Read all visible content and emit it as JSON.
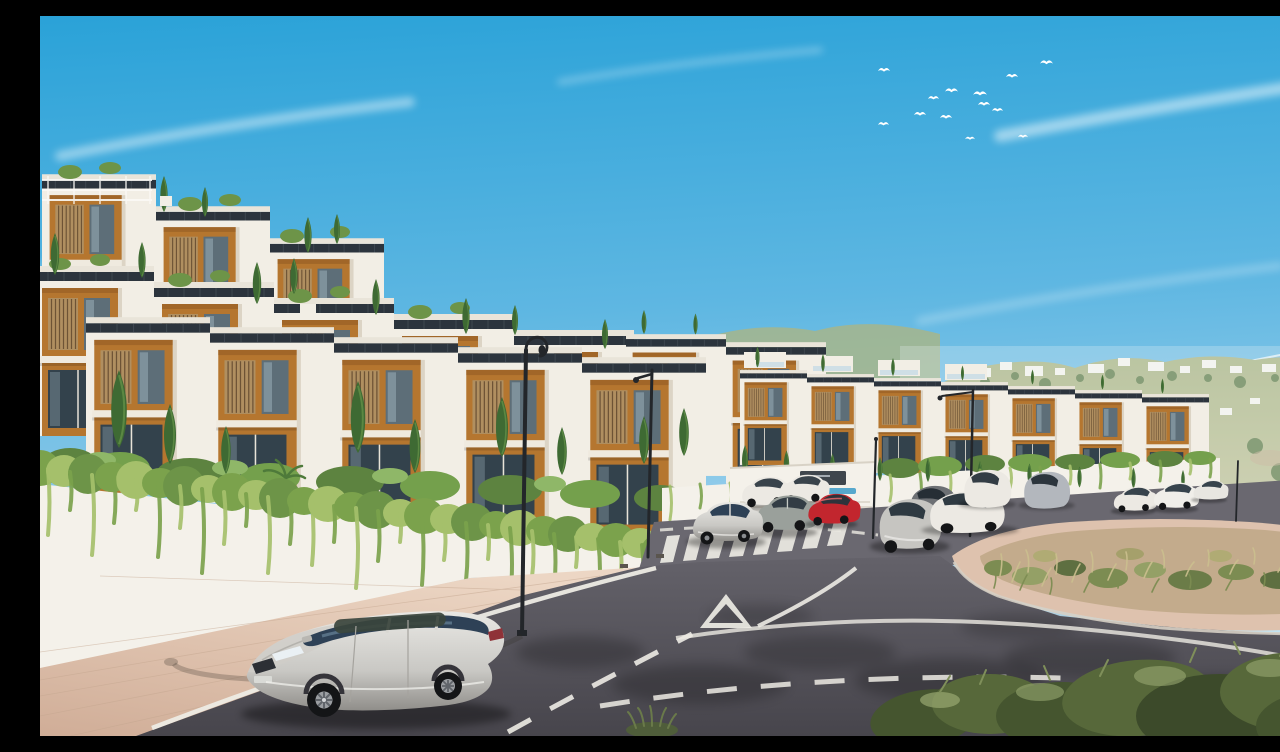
{
  "scene": {
    "title": "Hillside townhouse development - exterior rendering",
    "setting": "sunny Mediterranean hillside",
    "elements": [
      "terraced white and terracotta townhouses",
      "cypress trees",
      "ivy-draped retaining walls",
      "curved asphalt road with zebra crossing and yield triangle",
      "parked cars",
      "silver estate car in foreground",
      "street lamps",
      "scrubland traffic island",
      "distant villa-dotted hills",
      "glimpse of sea",
      "flock of white birds"
    ]
  },
  "palette": {
    "skyTop": "#2aa2d8",
    "skyMid": "#5fb7e2",
    "skyHorizon": "#cfe9f4",
    "cloud": "#ffffff",
    "sea": "#86bedb",
    "hill": "#aab584",
    "hillLight": "#c6c79d",
    "haze": "#eaf4f8",
    "buildingWhite": "#f2eee5",
    "buildingShade": "#dcd4c5",
    "parapet": "#e9e4d9",
    "terracotta": "#b5762f",
    "terracottaDark": "#8f5a22",
    "roofDark": "#2c343d",
    "windowGlass": "#5d6e78",
    "glassDark": "#33424c",
    "shutterWood": "#b08f60",
    "slat": "#6d5335",
    "cypress": "#3e6a33",
    "cypressLight": "#6f9c4f",
    "shrub": "#6d9448",
    "shrubDark": "#557f3c",
    "ivy": "#7ba24c",
    "ivyLight": "#a5c06b",
    "wallWhite": "#f4f1ea",
    "wallShade": "#d9d2c6",
    "paver": "#dcbfab",
    "paverLight": "#ecd6c4",
    "paverDark": "#d0ad97",
    "curb": "#cfc7bc",
    "asphalt": "#55525a",
    "asphaltDark": "#47454c",
    "asphaltLight": "#6a6870",
    "marking": "#edebe4",
    "lamp": "#23262a",
    "carSilver": "#c9c8c4",
    "carSilverLight": "#e9e8e4",
    "carWhite": "#ece9e3",
    "carGrey": "#9aa09b",
    "carDarkGrey": "#6d7074",
    "carRed": "#c2262e",
    "carGlass": "#2e4156",
    "tire": "#141517",
    "dirt": "#c3ab8c",
    "scrubGreen": "#7c8c52",
    "scrubDry": "#cbbf8e",
    "oliveDark": "#45552f",
    "olive": "#57683a",
    "oliveLight": "#98a871",
    "sign": "#3f464d",
    "water": "#57a8cd"
  },
  "sky": {
    "birds": 13,
    "cloudStreaks": 5
  },
  "buildings": {
    "rows": [
      {
        "id": "upper-terrace-row",
        "units": 3,
        "stories": 2
      },
      {
        "id": "second-terrace-row",
        "units": 5,
        "stories": 2
      },
      {
        "id": "front-row",
        "units": 5,
        "stories": 2
      },
      {
        "id": "mid-row",
        "units": 2,
        "stories": 2
      },
      {
        "id": "east-row",
        "units": 7,
        "stories": 2
      }
    ],
    "features": [
      "dark rooftop solar strips",
      "terracotta window recesses",
      "timber slat shutters",
      "roof terraces with planting",
      "glass balustrades"
    ]
  },
  "vegetation": {
    "cypressTrees": 40,
    "ivyStrands": 42,
    "hedges": 3,
    "scrubIsland": true,
    "foregroundOliveShrubs": true
  },
  "road": {
    "surface": "asphalt",
    "markings": [
      "zebra crosswalk",
      "yield triangle",
      "dashed centre line",
      "solid edge line",
      "sweeping junction curve"
    ],
    "sidewalk": "pink block pavers"
  },
  "streetLamps": 5,
  "vehicles": [
    {
      "id": "volvo-estate",
      "type": "station wagon",
      "color": "silver",
      "position": "foreground kerbside"
    },
    {
      "id": "white-suv-1",
      "type": "suv",
      "color": "white",
      "position": "left kerb mid distance"
    },
    {
      "id": "white-suv-2",
      "type": "suv",
      "color": "white",
      "position": "left kerb mid distance"
    },
    {
      "id": "grey-suv",
      "type": "suv",
      "color": "grey-green",
      "position": "left kerb mid distance"
    },
    {
      "id": "red-hatchback",
      "type": "hatchback",
      "color": "red",
      "position": "left kerb mid distance"
    },
    {
      "id": "silver-crossover",
      "type": "crossover",
      "color": "silver",
      "position": "left kerb mid distance"
    },
    {
      "id": "dark-grey-sedan",
      "type": "sedan",
      "color": "dark grey",
      "position": "right bend"
    },
    {
      "id": "silver-hatch",
      "type": "hatchback",
      "color": "silver",
      "position": "right bend"
    },
    {
      "id": "white-sedan",
      "type": "sedan",
      "color": "white",
      "position": "right bend"
    },
    {
      "id": "white-suv-3",
      "type": "suv",
      "color": "white",
      "position": "right bend"
    },
    {
      "id": "grey-suv-2",
      "type": "suv",
      "color": "light grey",
      "position": "right bend"
    },
    {
      "id": "white-car-far-1",
      "type": "sedan",
      "color": "white",
      "position": "far right kerb"
    },
    {
      "id": "white-car-far-2",
      "type": "suv",
      "color": "white",
      "position": "far right kerb"
    },
    {
      "id": "white-car-far-3",
      "type": "sedan",
      "color": "white",
      "position": "far right kerb"
    }
  ],
  "signage": {
    "entrancePlaque": {
      "color": "#3f464d",
      "textLegible": false
    }
  }
}
